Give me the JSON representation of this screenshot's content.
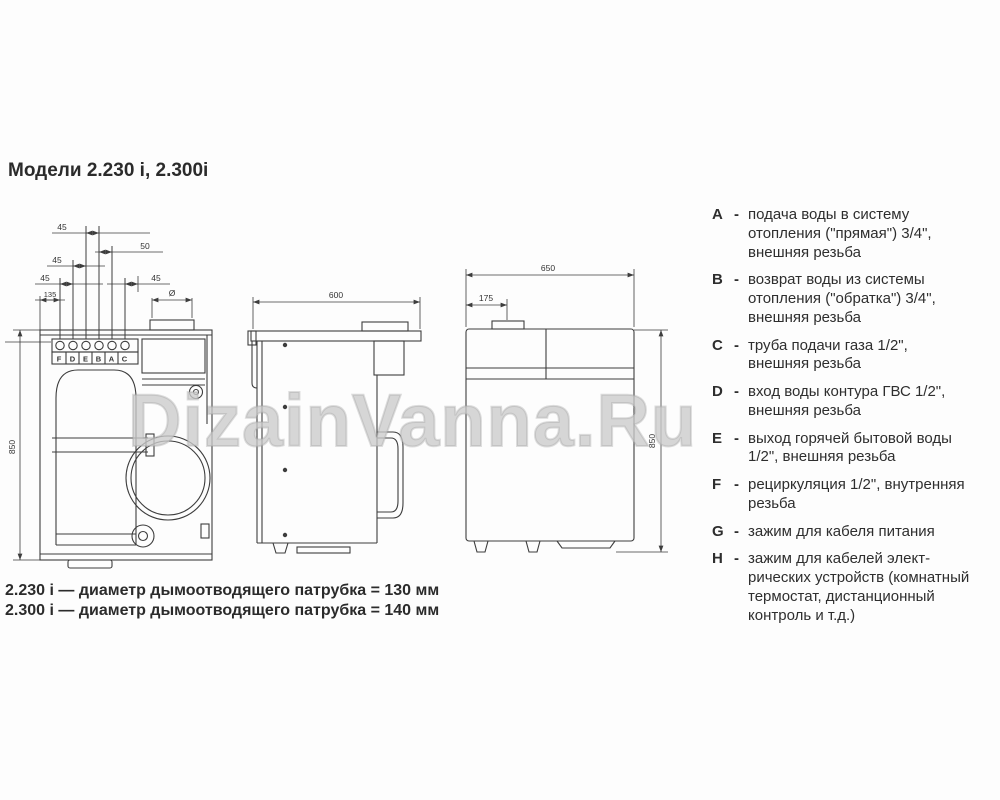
{
  "title": "Модели 2.230 i, 2.300i",
  "watermark": "DizainVanna.Ru",
  "legend": {
    "dash": "-",
    "items": [
      {
        "key": "A",
        "text": "подача воды в систему отопления (\"прямая\") 3/4\", внешняя резьба"
      },
      {
        "key": "B",
        "text": "возврат воды из системы отопления (\"обратка\") 3/4\", внешняя резьба"
      },
      {
        "key": "C",
        "text": "труба подачи газа 1/2\", внешняя резьба"
      },
      {
        "key": "D",
        "text": "вход воды контура ГВС 1/2\", внешняя резьба"
      },
      {
        "key": "E",
        "text": "выход горячей бытовой воды 1/2\", внешняя резьба"
      },
      {
        "key": "F",
        "text": "рециркуляция 1/2\", внутренняя резьба"
      },
      {
        "key": "G",
        "text": "зажим для кабеля питания"
      },
      {
        "key": "H",
        "text": "зажим для кабелей элект-рических устройств (комнатный термостат, дистанционный контроль и т.д.)"
      }
    ]
  },
  "notes": [
    {
      "model": "2.230 i",
      "text": "— диаметр дымоотводящего патрубка = 130 мм"
    },
    {
      "model": "2.300 i",
      "text": "— диаметр дымоотводящего патрубка = 140 мм"
    }
  ],
  "views": {
    "front": {
      "dims": {
        "row1": "45",
        "row2": "50",
        "row3": "45",
        "row4_left": "45",
        "row4_right": "45",
        "row5": "135",
        "flue": "Ø",
        "height": "850"
      },
      "connections": [
        "F",
        "D",
        "E",
        "B",
        "A",
        "C"
      ]
    },
    "side": {
      "dims": {
        "depth": "600"
      }
    },
    "back": {
      "dims": {
        "width": "650",
        "flue_offset": "175",
        "height": "850"
      }
    }
  },
  "colors": {
    "line": "#3d3d3d",
    "text": "#2e2e2e",
    "watermark": "#cbcbcb",
    "background": "#ffffff"
  }
}
